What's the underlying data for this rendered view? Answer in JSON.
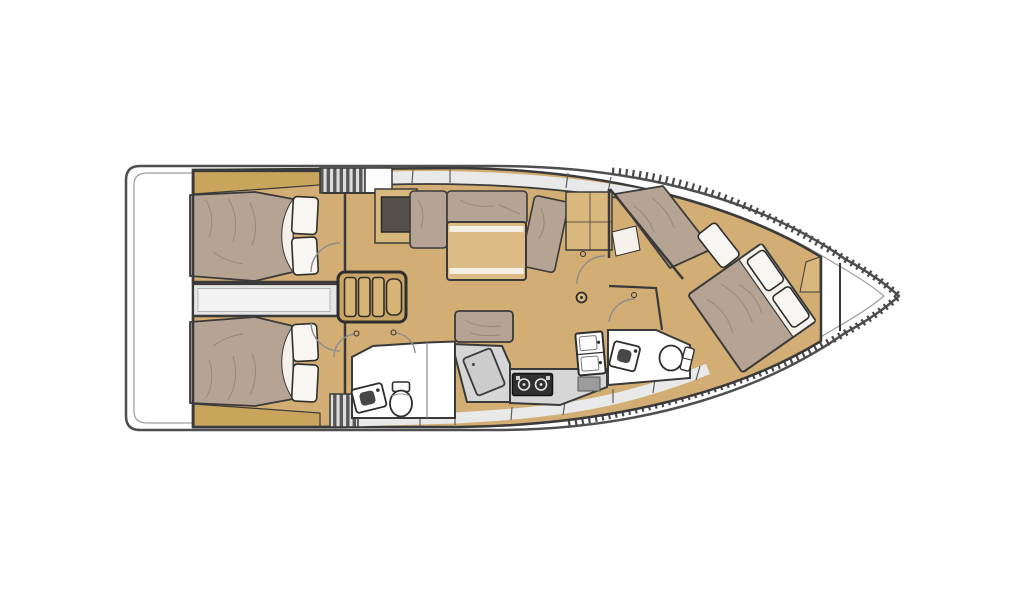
{
  "palette": {
    "white": "#ffffff",
    "hull_line": "#4f4f4f",
    "inner_line": "#9d9d9d",
    "wall": "#3a3a3a",
    "floor": "#d2ae74",
    "floor_light": "#d9b87e",
    "shelf": "#c9a45c",
    "mattress": "#b5a393",
    "mattress_line": "#8d7f6f",
    "pillow": "#f7f6f2",
    "off_white": "#f3f1ea",
    "table": "#dcbc84",
    "step": "#d8b576",
    "step_base": "#c9a666",
    "gray_zone": "#e9e9e9",
    "gray_mid": "#d6d6d6",
    "gray_panel": "#9c9c9c",
    "chart": "#cccccc",
    "corridor": "#e5e5e5",
    "corridor_inner": "#f2f2f2",
    "stove": "#303030",
    "dark_inset": "#56504a",
    "hatch_bg": "#dddddd",
    "hatch_line": "#585858",
    "arc": "#8d8d8d"
  },
  "diagram": {
    "type": "sailing-yacht-interior-layout-plan",
    "view": "top-down",
    "orientation": "bow-right",
    "hull_features": [
      "rounded-transom",
      "inner-deck-line",
      "toe-rail-hatching",
      "collision-bulkheads"
    ],
    "areas": [
      {
        "name": "aft-cabin-port",
        "fixtures": [
          "double-berth",
          "pillow",
          "pillow",
          "head-shelf"
        ]
      },
      {
        "name": "aft-cabin-starboard",
        "fixtures": [
          "double-berth",
          "pillow",
          "pillow",
          "head-shelf"
        ]
      },
      {
        "name": "engine-compartment-passage",
        "fixtures": []
      },
      {
        "name": "companionway",
        "fixtures": [
          "step-ladder",
          "cockpit-hatch",
          "side-hatch",
          "deck-locker"
        ]
      },
      {
        "name": "saloon",
        "fixtures": [
          "l-settee",
          "dining-table-with-leaves",
          "bench-seat",
          "sideboard-cabinet",
          "storage-locker",
          "mast-step"
        ]
      },
      {
        "name": "chart-area",
        "fixtures": [
          "desk",
          "tilted-chart-board"
        ]
      },
      {
        "name": "galley",
        "fixtures": [
          "two-burner-stove",
          "double-sink",
          "worktop",
          "under-counter-locker"
        ]
      },
      {
        "name": "aft-head",
        "fixtures": [
          "toilet",
          "washbasin",
          "shower-partition"
        ]
      },
      {
        "name": "forward-head",
        "fixtures": [
          "toilet",
          "washbasin"
        ]
      },
      {
        "name": "forward-cabin",
        "fixtures": [
          "island-double-berth",
          "pillow",
          "pillow",
          "single-berth",
          "pillow",
          "angled-bulkhead"
        ]
      },
      {
        "name": "bow-locker",
        "fixtures": [
          "bulkhead",
          "anchor-well"
        ]
      }
    ]
  }
}
